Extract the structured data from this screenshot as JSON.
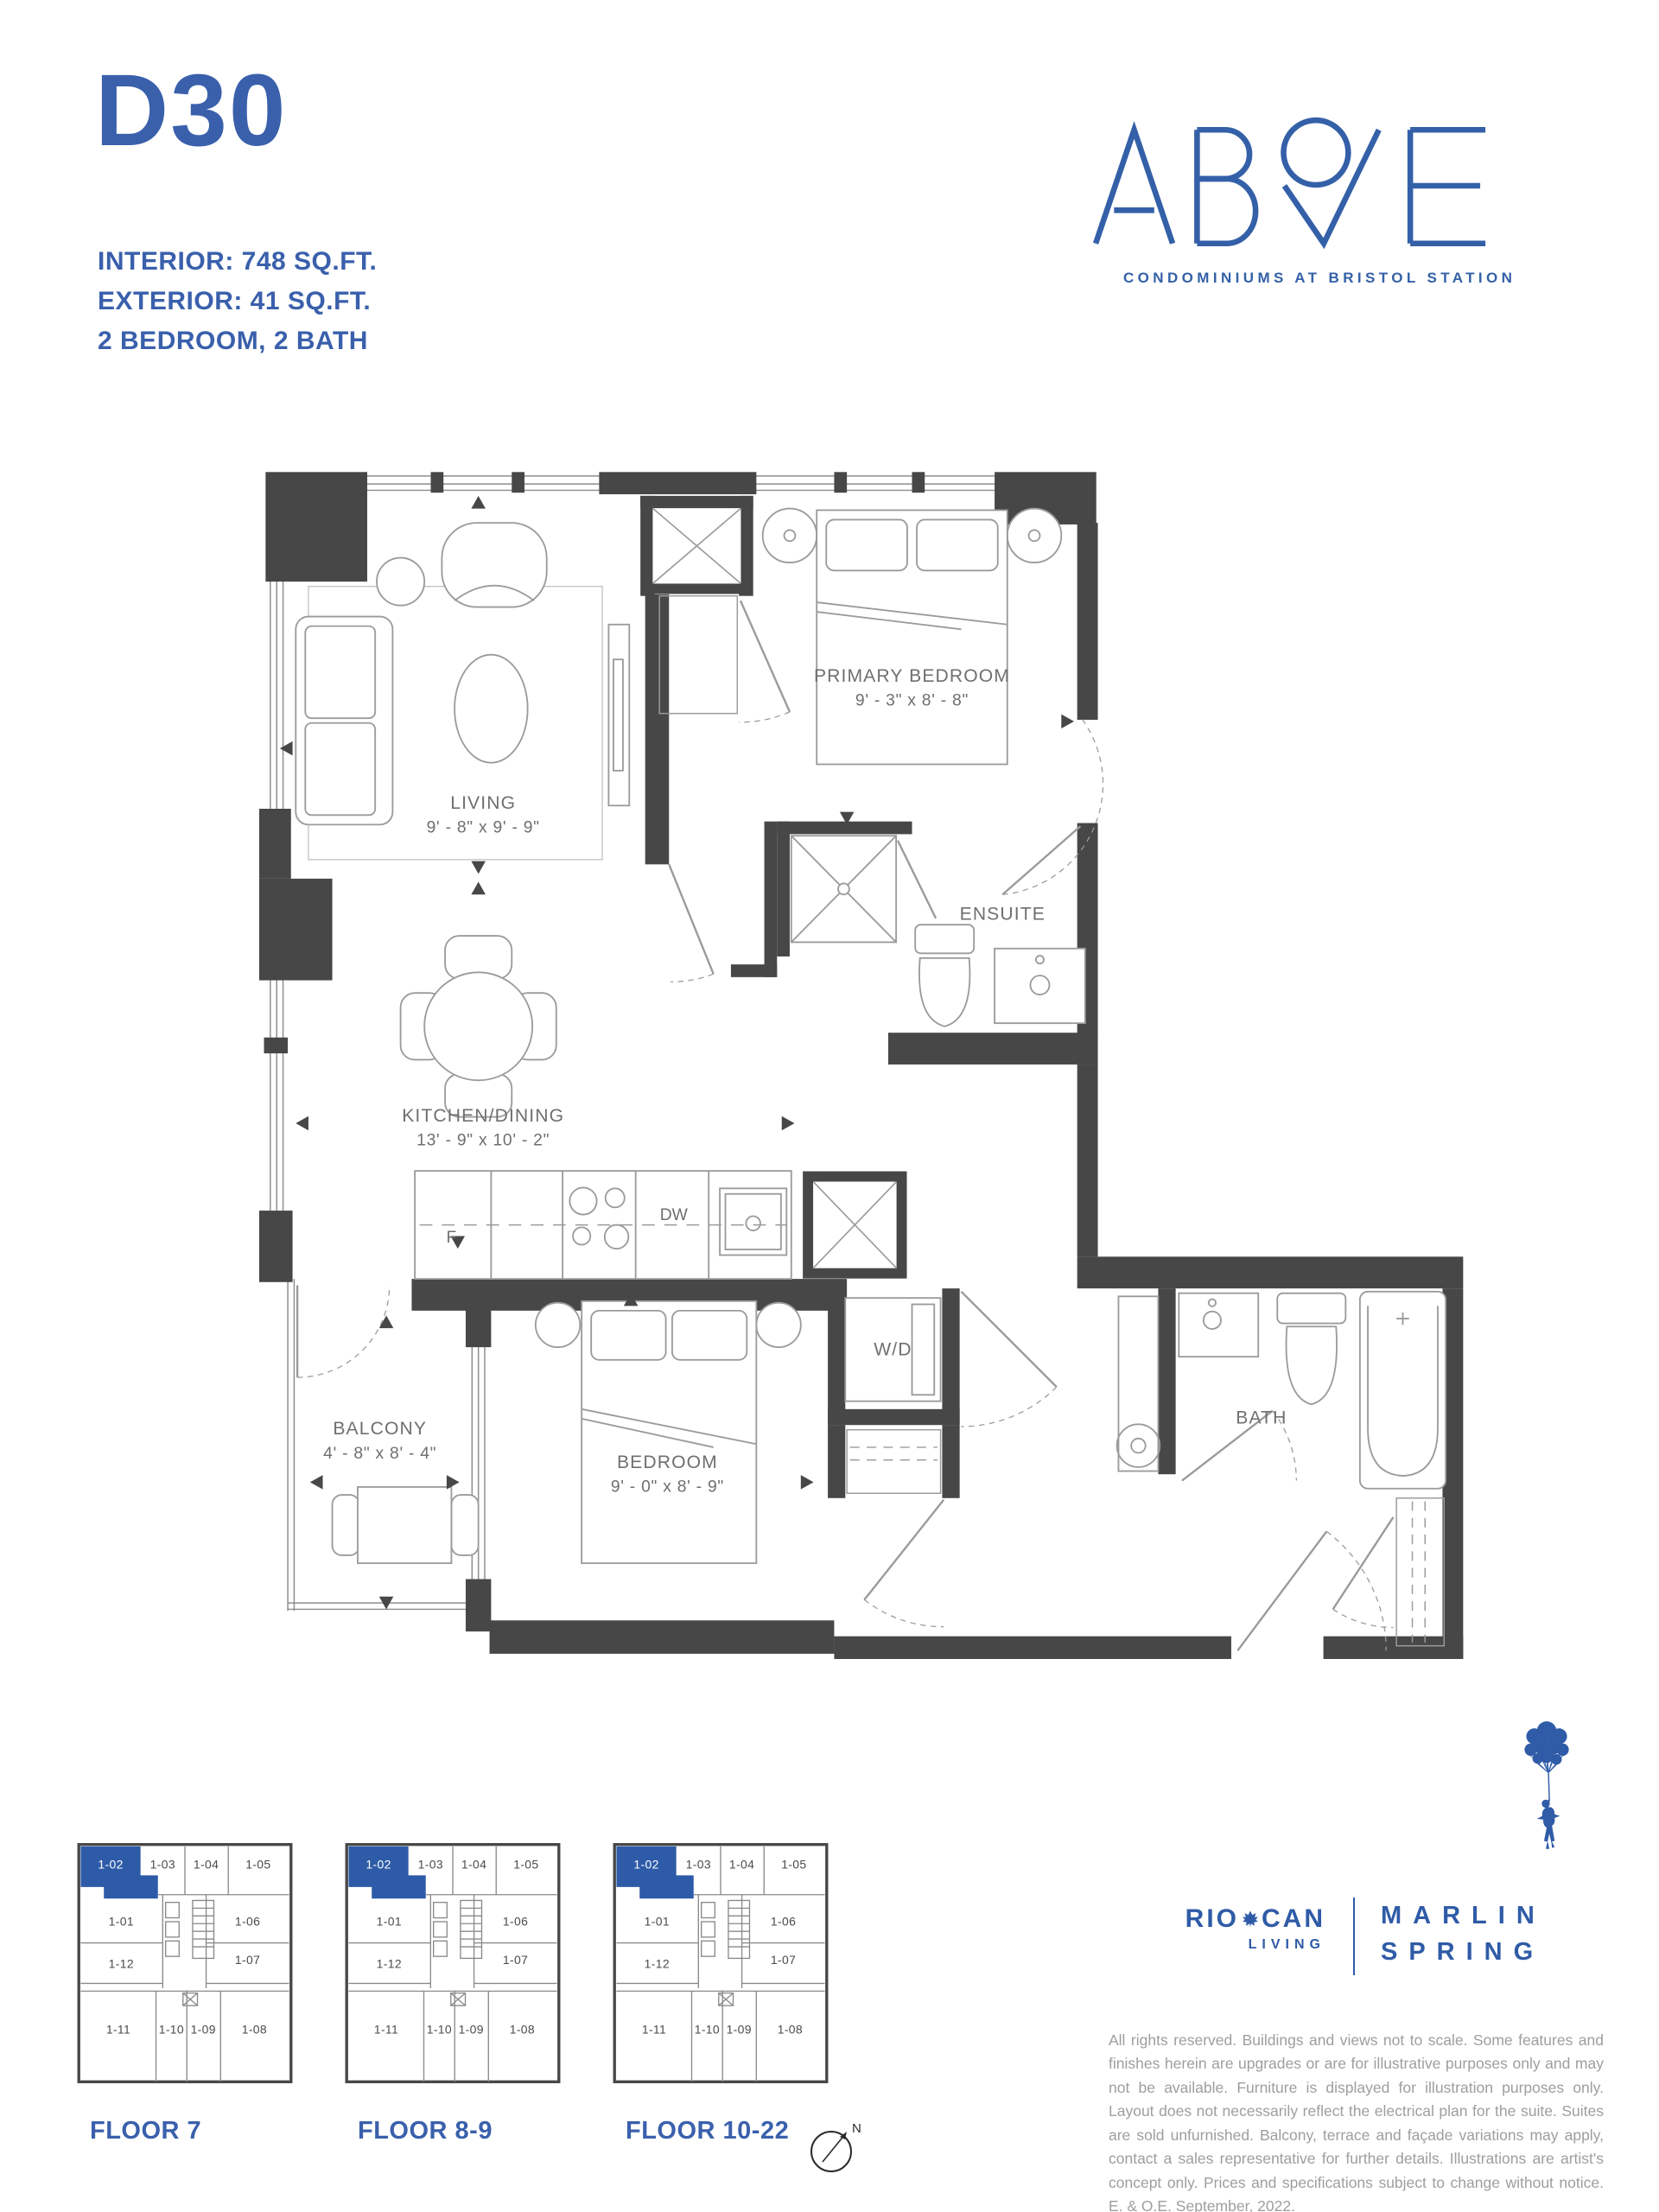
{
  "unit": {
    "name": "D30",
    "specs": [
      "INTERIOR: 748 SQ.FT.",
      "EXTERIOR: 41 SQ.FT.",
      "2 BEDROOM, 2 BATH"
    ]
  },
  "brand": {
    "name": "ABOVE",
    "tagline": "CONDOMINIUMS AT BRISTOL STATION",
    "accent_color": "#3A60AC",
    "wall_color": "#474747",
    "furniture_line_color": "#9B9B9B",
    "label_color": "#6F6F6F"
  },
  "floorplan": {
    "rooms": {
      "living": {
        "name": "LIVING",
        "dims": "9' - 8\" x 9' - 9\""
      },
      "primary": {
        "name": "PRIMARY BEDROOM",
        "dims": "9' - 3\" x 8' - 8\""
      },
      "ensuite": {
        "name": "ENSUITE"
      },
      "kitchen": {
        "name": "KITCHEN/DINING",
        "dims": "13' - 9\" x 10' - 2\""
      },
      "balcony": {
        "name": "BALCONY",
        "dims": "4' - 8\" x 8' - 4\""
      },
      "bedroom": {
        "name": "BEDROOM",
        "dims": "9' - 0\" x 8' - 9\""
      },
      "bath": {
        "name": "BATH"
      },
      "wd": {
        "name": "W/D"
      }
    },
    "appliances": {
      "fridge": "F",
      "dishwasher": "DW"
    }
  },
  "floorplates": {
    "floors": [
      {
        "label": "FLOOR 7"
      },
      {
        "label": "FLOOR 8-9"
      },
      {
        "label": "FLOOR 10-22"
      }
    ],
    "units": [
      "1-02",
      "1-03",
      "1-04",
      "1-05",
      "1-01",
      "1-06",
      "1-12",
      "1-07",
      "1-11",
      "1-10",
      "1-09",
      "1-08"
    ],
    "highlighted_unit": "1-02",
    "highlight_color": "#2E5BA8"
  },
  "developers": {
    "riocan": {
      "left": "RIO",
      "right": "CAN",
      "sub": "LIVING"
    },
    "marlin": {
      "line1": "MARLIN",
      "line2": "SPRING"
    }
  },
  "compass": {
    "north": "N"
  },
  "disclaimer": "All rights reserved. Buildings and views not to scale. Some features and finishes herein are upgrades or are for illustrative purposes only and may not be available. Furniture is displayed for illustration purposes only. Layout does not necessarily reflect the electrical plan for the suite. Suites are sold unfurnished. Balcony, terrace and façade variations may apply, contact a sales representative for further details. Illustrations are artist's concept only. Prices and specifications subject to change without notice. E. & O.E. September, 2022."
}
